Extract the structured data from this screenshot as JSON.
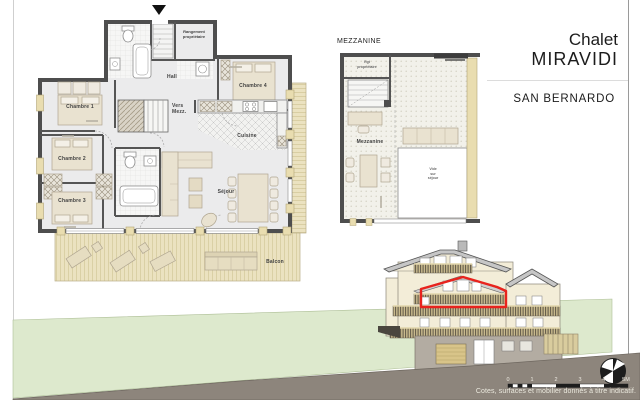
{
  "title_block": {
    "line1": "Chalet",
    "line2": "MIRAVIDI",
    "subtitle": "SAN BERNARDO"
  },
  "main_plan": {
    "rooms": {
      "chambre1": "Chambre 1",
      "chambre2": "Chambre 2",
      "chambre3": "Chambre 3",
      "chambre4": "Chambre 4",
      "hall": "Hall",
      "cuisine": "Cuisine",
      "sejour": "Séjour",
      "balcon": "Balcon",
      "vers_mezz_l1": "Vers",
      "vers_mezz_l2": "Mezz.",
      "rangement_l1": "Rangement",
      "rangement_l2": "propriétaire"
    }
  },
  "mezzanine_plan": {
    "title": "MEZZANINE",
    "rooms": {
      "rgt_l1": "Rgt",
      "rgt_l2": "propriétaire",
      "mezzanine": "Mezzanine",
      "vide_l1": "Vide",
      "vide_l2": "sur",
      "vide_l3": "séjour"
    }
  },
  "elevation": {
    "scale_labels": [
      "0",
      "1",
      "2",
      "3",
      "4",
      "5M"
    ],
    "caption": "Cotes, surfaces et mobilier donnés à titre indicatif.",
    "highlight_color": "#e8231d"
  },
  "colors": {
    "wall": "#4e4e4e",
    "floor": "#ebebec",
    "wood_deck": "#ebe2c0",
    "wood_post": "#e9ddb0",
    "furniture": "#e9e2d0",
    "facade": "#f3edd8",
    "roof": "#c6c6c6",
    "hill_green": "#dde9cd",
    "ground_brown": "#8d857c",
    "highlight_red": "#e8231d"
  }
}
